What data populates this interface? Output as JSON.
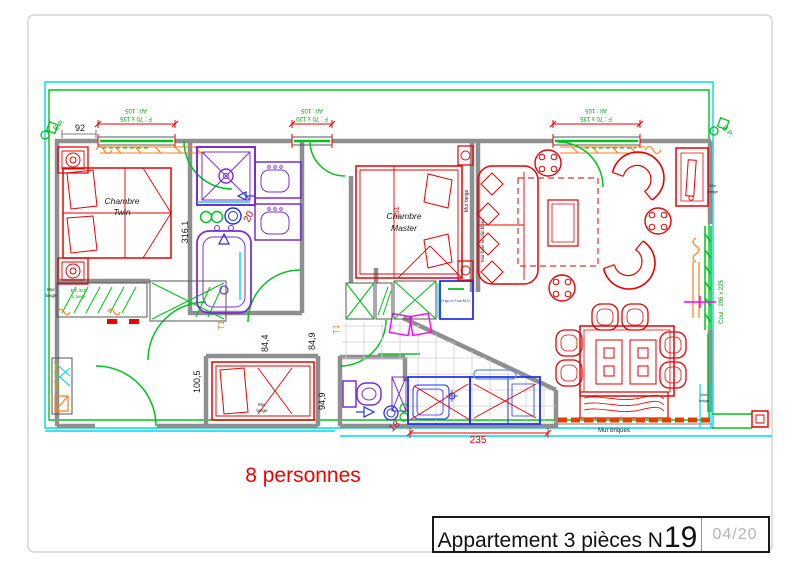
{
  "page": {
    "width": 800,
    "height": 565,
    "background": "#ffffff"
  },
  "title_block": {
    "title_prefix": "Appartement 3 pièces N",
    "apartment_number": "19",
    "date": "04/20"
  },
  "annotations": {
    "capacity": "8 personnes"
  },
  "rooms": {
    "twin_line1": "Chambre",
    "twin_line2": "Twin",
    "master_line1": "Chambre",
    "master_line2": "Master"
  },
  "windows": {
    "left": {
      "size": "F : 70 x 135",
      "sill": "All : 105"
    },
    "middle": {
      "size": "F : 70 x 120",
      "sill": "All : 105"
    },
    "right": {
      "size": "F : 70 x 135",
      "sill": "All : 105"
    }
  },
  "wall_labels": {
    "mur": "Mur",
    "beige": "beige",
    "mur_beige": "Mur beige",
    "mur_briques": "Mur briques",
    "mur_bois": "Mur bois en clin blanc"
  },
  "labels": {
    "ep": "E.P.",
    "coul": "Coul : 296 x 225",
    "frigo": "Frigo et Four M.O.",
    "closet_line1": "E.C./D.F.",
    "closet_line2": "L.beige",
    "t1": "T1"
  },
  "dimensions": {
    "d92": "92",
    "d316_1": "316,1",
    "d84_4": "84,4",
    "d84_9": "84,9",
    "d94_9": "94,9",
    "d100_5": "100,5",
    "d235": "235",
    "d18": "18",
    "d20": "20",
    "d151": "151"
  },
  "colors": {
    "furniture_red": "#e60202",
    "door_green": "#00c31d",
    "sanitary_purple": "#7b2fd2",
    "kitchen_blue": "#2230f0",
    "highlight_cyan": "#00d8e8",
    "radiator_orange": "#ff7d14",
    "door_magenta": "#ff00ff",
    "wall_gray": "#8f8f8f",
    "tile_gray": "#d0d0d0",
    "date_gray": "#b5b5b5"
  }
}
